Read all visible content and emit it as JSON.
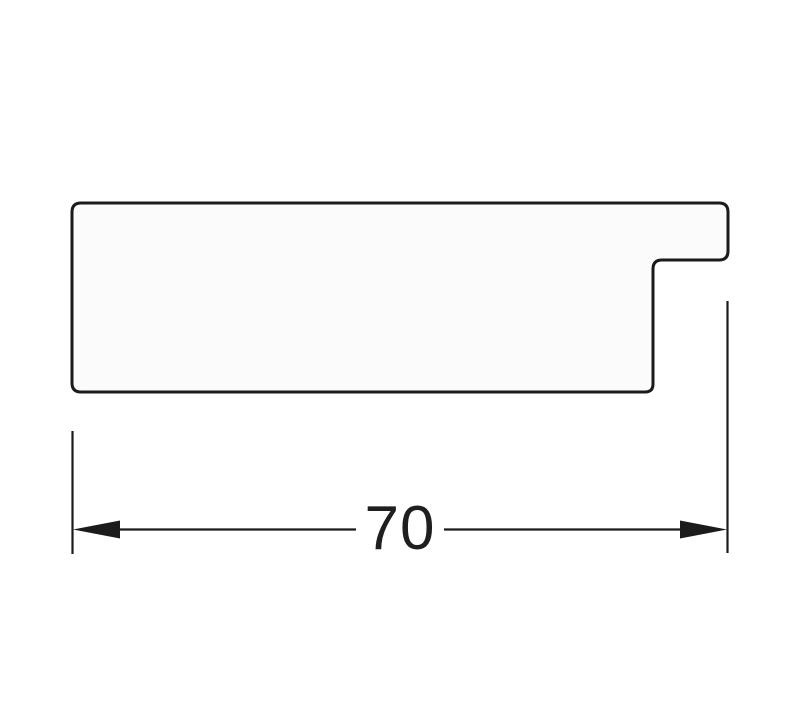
{
  "drawing": {
    "kind": "technical-cross-section-profile",
    "dimension": {
      "label": "70"
    }
  },
  "colors": {
    "line": "#1b1b1b",
    "fill": "#fbfbfb",
    "background": "#ffffff",
    "text": "#1f1f1f"
  }
}
